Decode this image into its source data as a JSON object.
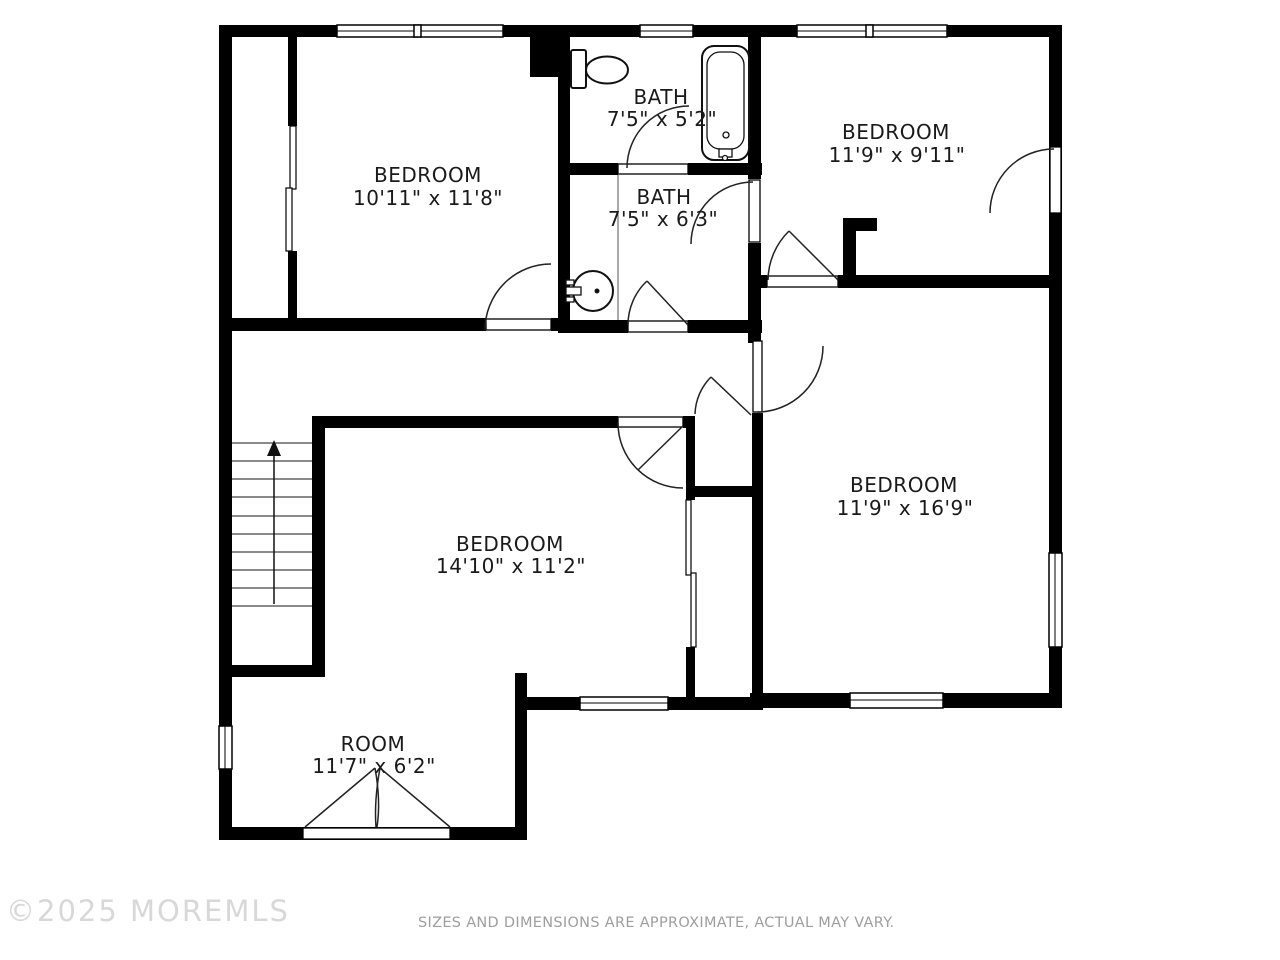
{
  "floorplan": {
    "rooms": [
      {
        "id": "bedroom-top-left",
        "name": "BEDROOM",
        "dims": "10'11\" x 11'8\""
      },
      {
        "id": "bath-upper",
        "name": "BATH",
        "dims": "7'5\" x 5'2\""
      },
      {
        "id": "bedroom-top-right",
        "name": "BEDROOM",
        "dims": "11'9\" x 9'11\""
      },
      {
        "id": "bath-lower",
        "name": "BATH",
        "dims": "7'5\" x 6'3\""
      },
      {
        "id": "bedroom-right",
        "name": "BEDROOM",
        "dims": "11'9\" x 16'9\""
      },
      {
        "id": "bedroom-middle",
        "name": "BEDROOM",
        "dims": "14'10\" x 11'2\""
      },
      {
        "id": "room-bonus",
        "name": "ROOM",
        "dims": "11'7\" x 6'2\""
      }
    ],
    "fixtures": [
      "toilet",
      "bathtub",
      "sink",
      "stairs-up-arrow"
    ],
    "colors": {
      "wall": "#000000",
      "background": "#ffffff",
      "label": "#1a1a1a",
      "watermark": "#d8d8d8",
      "disclaimer": "#9e9e9e"
    }
  },
  "footer": {
    "watermark": "©2025 MOREMLS",
    "disclaimer": "SIZES AND DIMENSIONS ARE APPROXIMATE, ACTUAL MAY VARY."
  }
}
